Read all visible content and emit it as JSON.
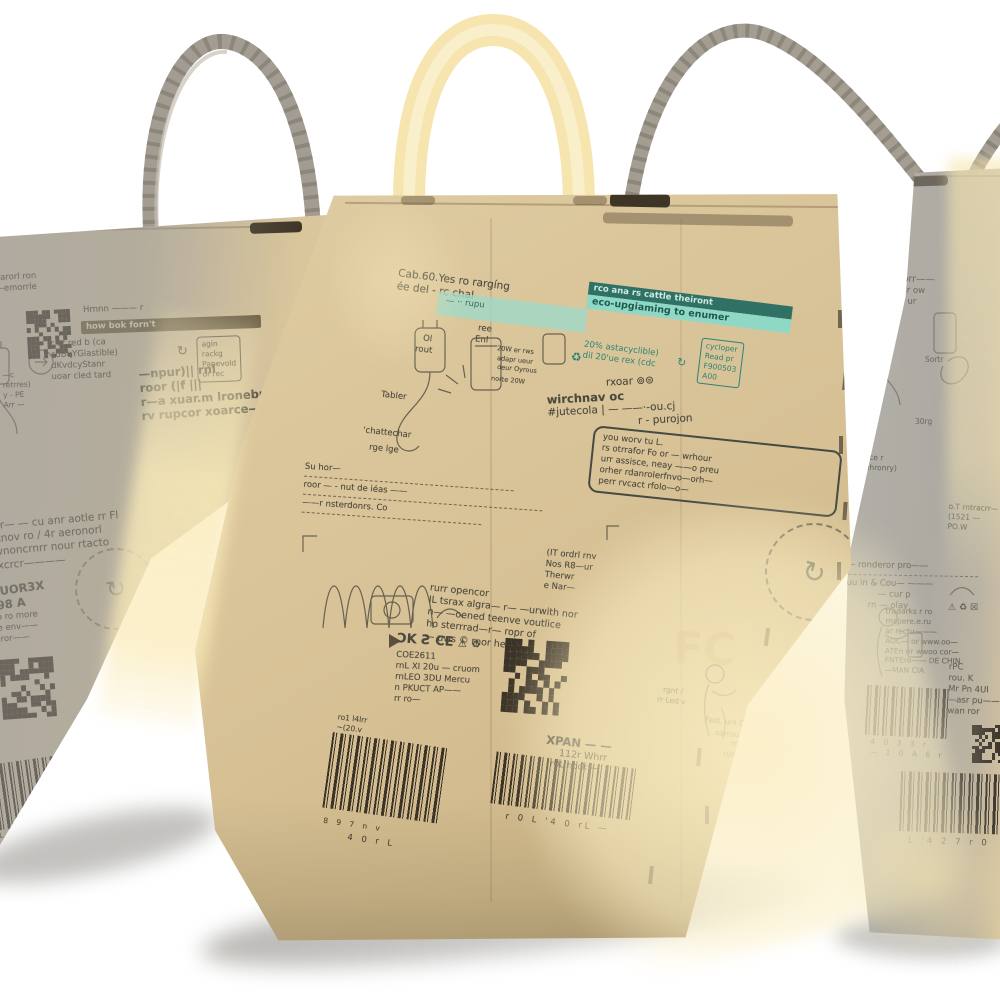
{
  "icons": {
    "recycle": "♻",
    "cycle": "↻",
    "warning": "⚠",
    "crossbox": "☒",
    "copyright_smileys": "⊚⊜"
  },
  "colors": {
    "kraft": "#d5c094",
    "teal_banner": "#8fd8c6",
    "teal_dark": "#2f7265",
    "teal_text": "#2e8374",
    "print": "#4b493d",
    "banner_olive": "#6d6044",
    "handle_cream": "#f6e5ae",
    "handle_gray": "#a29c92",
    "barcode_ink": "#3a3226"
  },
  "left_box": {
    "top_tiny": [
      "narorl ron",
      "—emorrle"
    ],
    "banner_above": "Hrnnn ——— r",
    "banner": "how bok forn't",
    "recycle_lines": [
      "r vr red b (ca",
      "cuBqYGlastible)",
      "dKvdcyStanr",
      "uoar cled tard"
    ],
    "recycle_box": [
      "agin",
      "rackg",
      "Papevold",
      "or rec"
    ],
    "side_tiny": [
      "—c",
      "retrres)",
      "y - PE",
      "Arr —"
    ],
    "logo_lines": [
      "—npur)|| rnl",
      "roor  (|f |||",
      "r—a xuar.m lronebr——",
      "rv rupcor xoarce——"
    ],
    "para": [
      "o ur— — cu anr aotle rr Fl",
      "Fotnov ro / 4r aeronorl",
      "wwnoncrnrr nour rtacto",
      "w.xcrcr————"
    ],
    "vert_code": [
      "UT",
      "rXUOR3X",
      "O98 A"
    ],
    "lower_tiny": [
      "rrron o ro more",
      "ns ane env——",
      "are rnror——",
      "ou."
    ],
    "barcode_digits": "L 8 9 r 5 w"
  },
  "center_box": {
    "top_lines": [
      "Cab.60.Yes ro rargíng",
      "ée del - rc chal"
    ],
    "teal_strip": "— ·· rupu",
    "banner_top": "rco ana rs cattle theiront",
    "banner_bottom": "eco-upgiaming to enumer",
    "eco_lines": [
      "20% astacyclible)",
      "dil 20'ue rex (cdc"
    ],
    "eco_box": [
      "cycloper",
      "Read pr",
      "F900503",
      "A00"
    ],
    "diagram_labels": [
      "Ol",
      "rout",
      "ree",
      "Enl",
      "20W er rws",
      "adapr ueur",
      "deur Oyrous",
      "norte 20W",
      "Tabler",
      "'chattechar",
      "rge   lge"
    ],
    "logo_lines": [
      "rxoar",
      "wirchnav oc",
      "#jutecola | — ——·-ou.cj",
      "r - purojon"
    ],
    "warranty_lines": [
      "you worv tu L.",
      "rs otrrafor Fo or — wrhour",
      "urr assisce, neay ——o preu",
      "orher rdanrolerfnvo—orh—",
      "perr rvcact rfolo—o—"
    ],
    "divider_lines": [
      "Su hor—",
      "roor — -  nut de iéas ——",
      "——r nsterdonrs. Co"
    ],
    "mid_lines": [
      "(IT ordrl rnv",
      "Nos R8—ur",
      "Therwr",
      "e Nar—"
    ],
    "para": [
      "rurr opencor",
      "IL tsrax algra— r— —urwith nor",
      "n— —oened teenve voutlice",
      "ho sterrrad—r— ropr of",
      "— uws © rnor herry"
    ],
    "cert_marks": [
      "ƆK",
      "Ƨ",
      "CE"
    ],
    "code_lines": [
      "COE2611",
      "rnL XI 20u — cruom",
      "rnLEO 3DU Mercu",
      "n PKUCT AP——",
      "rr ro—"
    ],
    "fcc": "FC",
    "xpan_lines": [
      "XPAN — —",
      "112r Whrr",
      "rUL hock —"
    ],
    "barcode1_top": [
      "ro1 l4lrr",
      "~(20.v"
    ],
    "barcode1_digits": [
      "8 9 7 n v",
      "4 0 r L"
    ],
    "barcode2_digits": "r 0 L  '4 0 rL —",
    "sketch_labels": [
      "rgnt /",
      "rr Led v",
      "Fast. urs Grad Pr",
      "samsungrs",
      "rd Arr. r",
      "rung. r"
    ]
  },
  "right_box": {
    "top_lines": [
      "OW Co 20 rorr——",
      "—able 4 adeur ow",
      "rv rr secte 20 ur"
    ],
    "sketch_labels": [
      "Sortr",
      "adurr",
      "30rg"
    ],
    "fr_note": [
      "(hence r",
      "or rehronry)"
    ],
    "dash_lines": [
      "ro— ronderor pro——",
      "—uu in & Cou— ———",
      "— cur p",
      "rn — olay"
    ],
    "intr_lines": [
      "o.T rntracrr—",
      "(1521 —",
      "PO.W"
    ],
    "dense_lines": [
      "tradarks r ro",
      "rnspere.e.ru",
      "ar rectu———",
      "AOC— or   www.oo—",
      "ATEn or  wwoo cor—",
      "FNTEro——  DE CHIN",
      "—MAN CIA"
    ],
    "model_lines": [
      "rPC",
      "rou. K",
      "Mr Pn 4UI",
      "—asr pu——",
      "wan ror"
    ],
    "barcodeA_digits": [
      "4 0 3 3 r",
      "— 1 0 A 6 r"
    ],
    "barcodeB_digits": "L '4 2 7 r 0"
  }
}
